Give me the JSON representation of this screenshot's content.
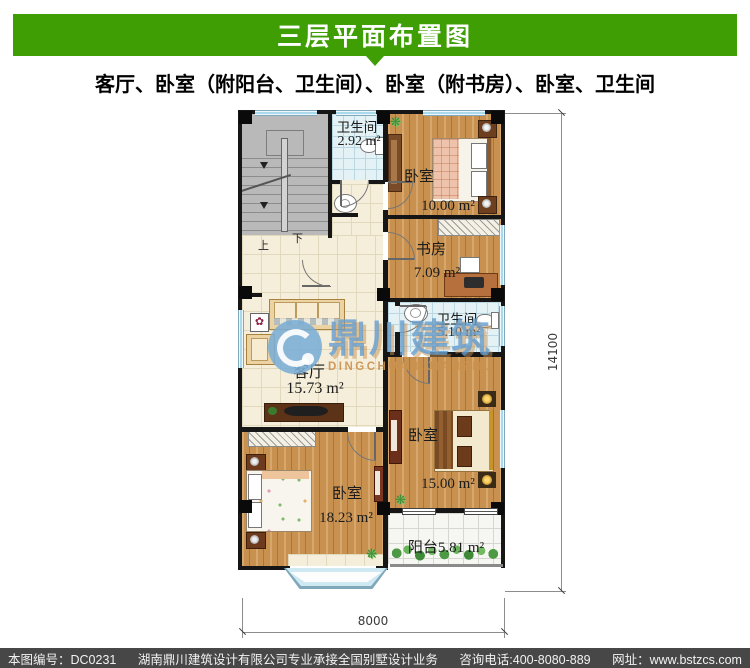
{
  "header": {
    "title": "三层平面布置图",
    "subtitle": "客厅、卧室（附阳台、卫生间）、卧室（附书房）、卧室、卫生间"
  },
  "plan": {
    "rooms": {
      "bath_top": {
        "name": "卫生间",
        "area": "2.92 m²"
      },
      "bedroom_top": {
        "name": "卧室",
        "area": "10.00 m²"
      },
      "study": {
        "name": "书房",
        "area": "7.09 m²"
      },
      "bath_mid": {
        "name": "卫生间",
        "area": "5.10 m²"
      },
      "living": {
        "name": "客厅",
        "area": "15.73 m²"
      },
      "bedroom_right": {
        "name": "卧室",
        "area": "15.00 m²"
      },
      "bedroom_bottom": {
        "name": "卧室",
        "area": "18.23 m²"
      },
      "balcony": {
        "label": "阳台5.81 m²"
      }
    },
    "stairs": {
      "up": "上",
      "down": "下"
    },
    "dimensions": {
      "width": "8000",
      "height": "14100"
    }
  },
  "watermark": {
    "name_cn": "鼎川建筑",
    "name_en": "DINGCHUAN.JIANZHU"
  },
  "footer": {
    "sheet_no": "本图编号：DC0231",
    "company": "湖南鼎川建筑设计有限公司专业承接全国别墅设计业务",
    "phone": "咨询电话:400-8080-889",
    "website": "网址：www.bstzcs.com"
  },
  "colors": {
    "header_green": "#3f9e04",
    "footer_gray": "#474747",
    "wood": "#c9914f",
    "tile_cream": "#f5eedb",
    "tile_blue": "#e4f1f5",
    "watermark_blue": "#689ecc",
    "watermark_tan": "#c9924e"
  }
}
